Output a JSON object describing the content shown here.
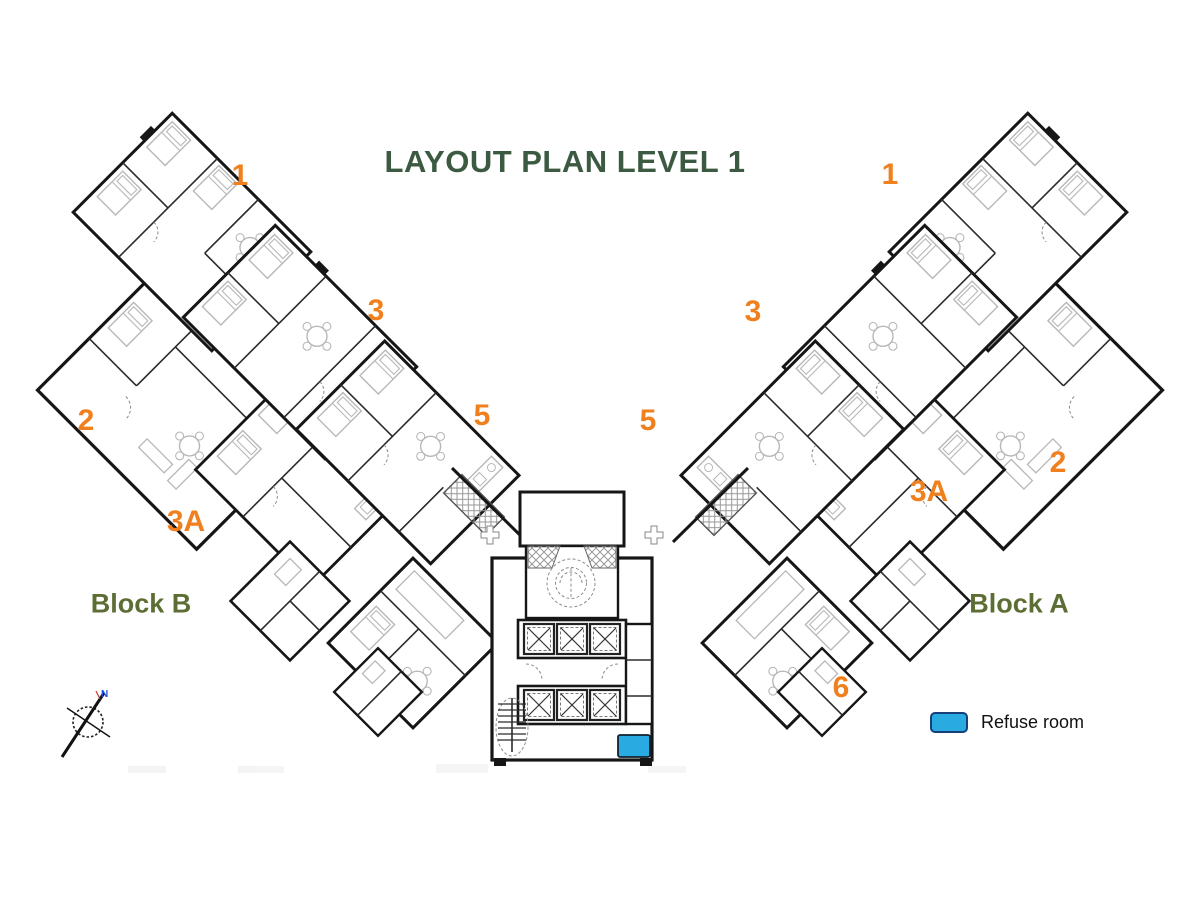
{
  "title": "LAYOUT PLAN LEVEL 1",
  "colors": {
    "title": "#3c5a41",
    "block_label": "#5c6e33",
    "unit_label": "#f07f1d",
    "refuse_fill": "#29abe2",
    "refuse_border": "#173f7a",
    "legend_text": "#111111"
  },
  "blocks": [
    {
      "name": "Block B",
      "x": 141,
      "y": 604
    },
    {
      "name": "Block A",
      "x": 1019,
      "y": 604
    }
  ],
  "unit_labels": [
    {
      "text": "1",
      "x": 240,
      "y": 176
    },
    {
      "text": "3",
      "x": 376,
      "y": 311
    },
    {
      "text": "5",
      "x": 482,
      "y": 416
    },
    {
      "text": "2",
      "x": 86,
      "y": 421
    },
    {
      "text": "3A",
      "x": 186,
      "y": 522
    },
    {
      "text": "1",
      "x": 890,
      "y": 175
    },
    {
      "text": "3",
      "x": 753,
      "y": 312
    },
    {
      "text": "5",
      "x": 648,
      "y": 421
    },
    {
      "text": "3A",
      "x": 929,
      "y": 492
    },
    {
      "text": "2",
      "x": 1058,
      "y": 463
    },
    {
      "text": "6",
      "x": 841,
      "y": 688
    }
  ],
  "legend": {
    "label": "Refuse room"
  },
  "compass": {
    "label": "N"
  }
}
